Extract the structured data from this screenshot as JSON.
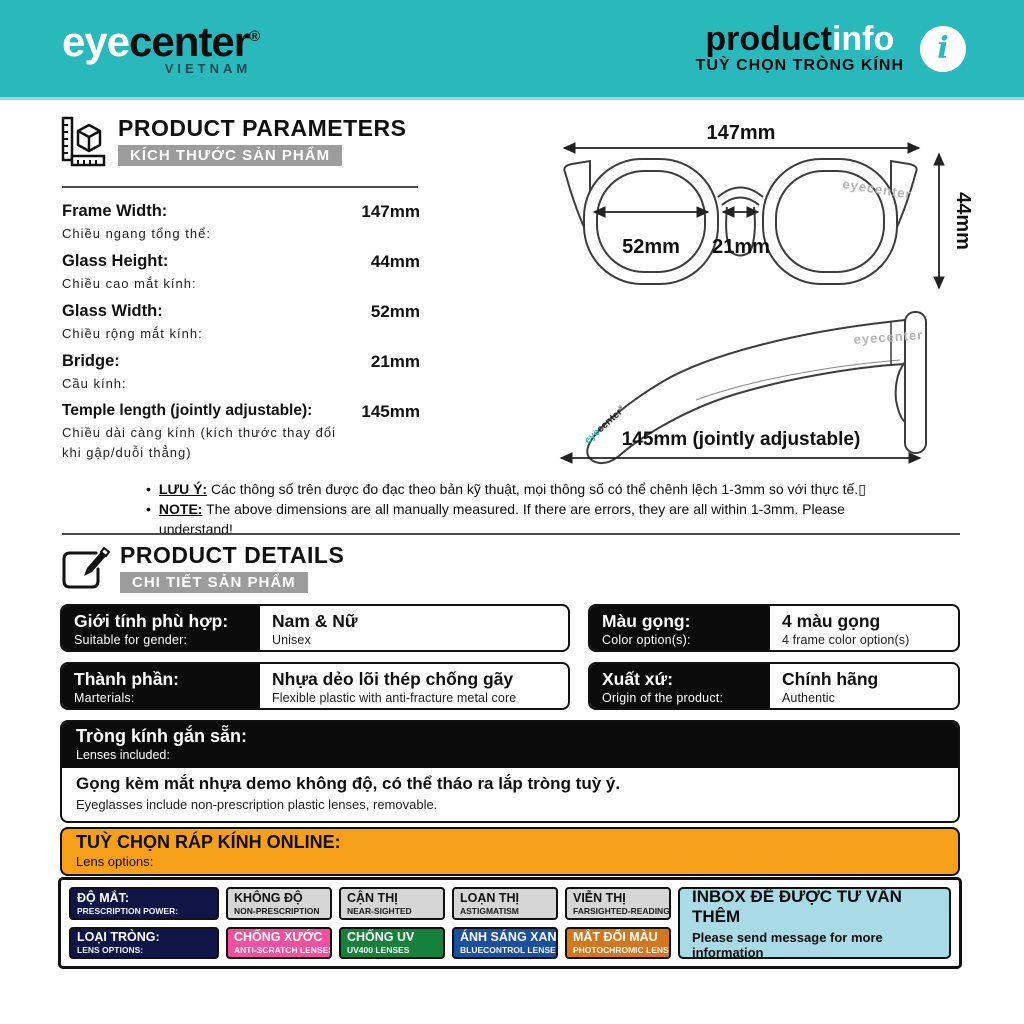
{
  "colors": {
    "header_teal": "#29b9bd",
    "accent_orange": "#f6a019",
    "navy": "#101548",
    "gray_chip": "#d6d6d6",
    "pink": "#f0509e",
    "green": "#17813c",
    "blue": "#1b4fa0",
    "photochromic_orange": "#d2771e",
    "inbox_blue": "#a9dbe6"
  },
  "header": {
    "brand_eye": "eye",
    "brand_center": "center",
    "brand_reg": "®",
    "brand_sub": "VIETNAM",
    "title_product": "product",
    "title_info": "info",
    "subtitle": "TUỲ CHỌN TRÒNG KÍNH",
    "info_icon": "i"
  },
  "parameters": {
    "title": "PRODUCT PARAMETERS",
    "subtitle": "KÍCH THƯỚC SẢN PHẨM",
    "rows": [
      {
        "label": "Frame Width:",
        "sublabel": "Chiều ngang tổng thể:",
        "value": "147mm"
      },
      {
        "label": "Glass Height:",
        "sublabel": "Chiều cao mắt kính:",
        "value": "44mm"
      },
      {
        "label": "Glass Width:",
        "sublabel": "Chiều rộng mắt kính:",
        "value": "52mm"
      },
      {
        "label": "Bridge:",
        "sublabel": "Cầu kính:",
        "value": "21mm"
      },
      {
        "label": "Temple length (jointly adjustable):",
        "sublabel": "Chiều dài càng kính (kích thước thay đổi khi gập/duỗi thẳng)",
        "value": "145mm"
      }
    ]
  },
  "diagram": {
    "front": {
      "width_label": "147mm",
      "height_label": "44mm",
      "lens_label": "52mm",
      "bridge_label": "21mm",
      "watermark": "eyecenter"
    },
    "side": {
      "length_label": "145mm (jointly adjustable)",
      "watermark": "eyecenter",
      "tip_logo_eye": "eye",
      "tip_logo_center": "center",
      "tip_logo_reg": "®"
    }
  },
  "notes": [
    {
      "bullet": "•",
      "prefix": "LƯU Ý:",
      "text": " Các thông số trên được đo đạc theo bản kỹ thuật, mọi thông số có thể chênh lệch 1-3mm so với thực tế.▯"
    },
    {
      "bullet": "•",
      "prefix": "NOTE:",
      "text": " The above dimensions are all manually measured. If there are errors, they are all within 1-3mm. Please understand!"
    }
  ],
  "details": {
    "title": "PRODUCT DETAILS",
    "subtitle": "CHI TIẾT SẢN PHẨM",
    "cells": [
      {
        "label": "Giới tính phù hợp:",
        "sublabel": "Suitable for gender:",
        "value": "Nam & Nữ",
        "subvalue": "Unisex"
      },
      {
        "label": "Màu gọng:",
        "sublabel": "Color option(s):",
        "value": "4 màu gọng",
        "subvalue": "4 frame color option(s)"
      },
      {
        "label": "Thành phần:",
        "sublabel": "Marterials:",
        "value": "Nhựa dẻo lõi thép chống gãy",
        "subvalue": "Flexible plastic with anti-fracture metal core"
      },
      {
        "label": "Xuất xứ:",
        "sublabel": "Origin of the product:",
        "value": "Chính hãng",
        "subvalue": "Authentic"
      }
    ],
    "lenses_included": {
      "label": "Tròng kính gắn sẵn:",
      "sublabel": "Lenses included:",
      "value": "Gọng kèm mắt nhựa demo không độ, có thể tháo ra lắp tròng tuỳ ý.",
      "subvalue": "Eyeglasses include non-prescription plastic lenses, removable."
    }
  },
  "lens_options": {
    "header": "TUỲ CHỌN RÁP KÍNH ONLINE:",
    "subheader": "Lens options:",
    "row1": [
      {
        "label": "ĐỘ MẮT:",
        "sublabel": "PRESCRIPTION POWER:",
        "bg": "#101548",
        "fg": "#ffffff"
      },
      {
        "label": "KHÔNG ĐỘ",
        "sublabel": "NON-PRESCRIPTION",
        "bg": "#d6d6d6",
        "fg": "#111111"
      },
      {
        "label": "CẬN THỊ",
        "sublabel": "NEAR-SIGHTED",
        "bg": "#d6d6d6",
        "fg": "#111111"
      },
      {
        "label": "LOẠN THỊ",
        "sublabel": "ASTIGMATISM",
        "bg": "#d6d6d6",
        "fg": "#111111"
      },
      {
        "label": "VIỄN THỊ",
        "sublabel": "FARSIGHTED-READING",
        "bg": "#d6d6d6",
        "fg": "#111111"
      }
    ],
    "row2": [
      {
        "label": "LOẠI TRÒNG:",
        "sublabel": "LENS OPTIONS:",
        "bg": "#101548",
        "fg": "#ffffff"
      },
      {
        "label": "CHỐNG XƯỚC",
        "sublabel": "ANTI-SCRATCH LENSES",
        "bg": "#f0509e",
        "fg": "#ffffff"
      },
      {
        "label": "CHỐNG UV",
        "sublabel": "UV400 LENSES",
        "bg": "#17813c",
        "fg": "#ffffff"
      },
      {
        "label": "ÁNH SÁNG XANH",
        "sublabel": "BLUECONTROL LENSES",
        "bg": "#1b4fa0",
        "fg": "#ffffff"
      },
      {
        "label": "MẮT ĐỔI MÀU",
        "sublabel": "PHOTOCHROMIC LENSES",
        "bg": "#d2771e",
        "fg": "#ffffff"
      }
    ],
    "inbox": {
      "line1": "INBOX ĐỂ ĐƯỢC TƯ VẤN THÊM",
      "line2": "Please send message for more information"
    }
  }
}
